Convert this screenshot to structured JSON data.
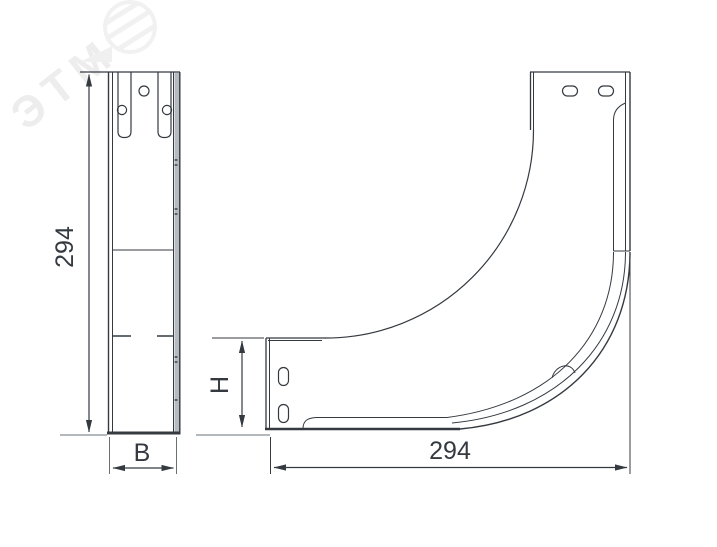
{
  "watermark": {
    "text": "ЭТМ",
    "color": "#ededed"
  },
  "dimensions": {
    "front_height": "294",
    "front_width": "B",
    "side_arm_height": "H",
    "side_length": "294"
  },
  "colors": {
    "line": "#343a40",
    "extension_gray": "#9aa0a6",
    "flange_band_fill": "#b5bac0",
    "background": "#ffffff"
  }
}
